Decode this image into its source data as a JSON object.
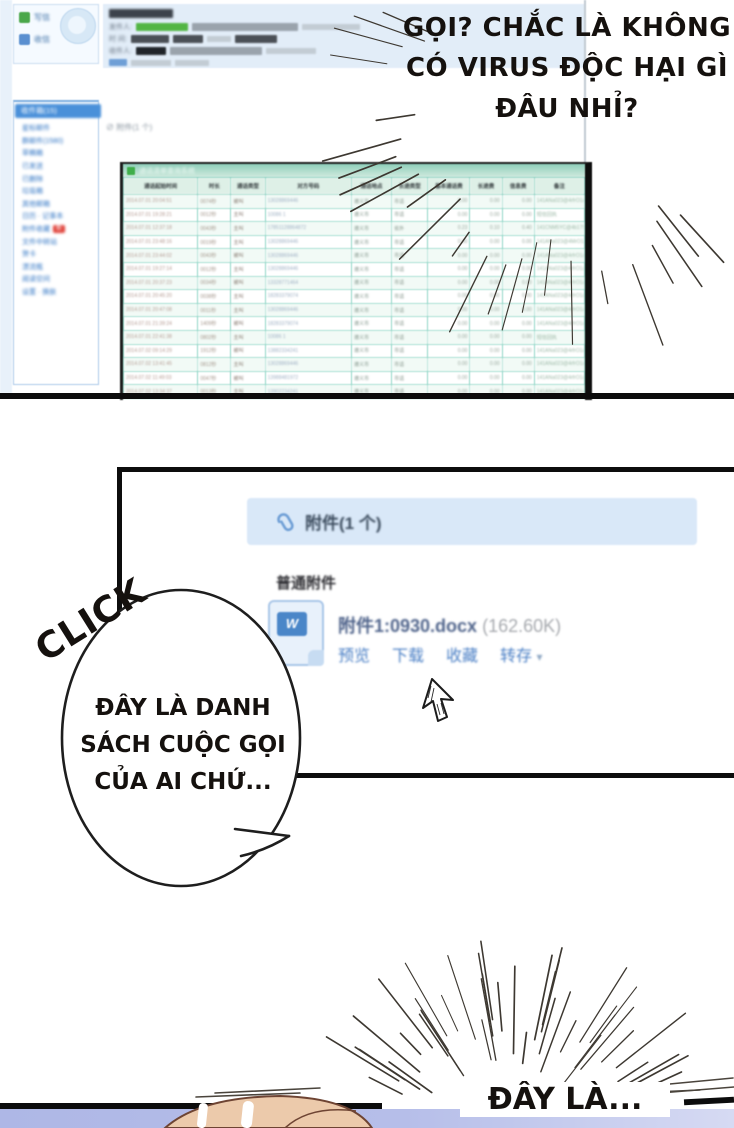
{
  "speech": {
    "bubble_top_lines": [
      "GỌI? CHẮC LÀ KHÔNG",
      "CÓ VIRUS ĐỘC HẠI GÌ",
      "ĐÂU NHỈ?"
    ],
    "click_label": "CLICK",
    "bubble_mid_lines": [
      "ĐÂY LÀ DANH",
      "SÁCH CUỘC GỌI",
      "CỦA AI CHỨ..."
    ],
    "bottom_caption": "ĐÂY LÀ..."
  },
  "mail": {
    "compose_label": "写信",
    "inbox_label": "收信",
    "sidebar": {
      "selected": "收件箱(15)",
      "items": [
        "星标邮件",
        "群邮件(1580)",
        "草稿箱",
        "已发送",
        "已删除",
        "垃圾箱",
        "其他邮箱",
        "日历 · 记事本",
        "附件收藏",
        "文件中转站",
        "贺卡",
        "漂流瓶",
        "阅读空间",
        "设置 · 换肤"
      ],
      "badge_item_index": 8,
      "badge_text": "新"
    },
    "header_fields": {
      "from_label": "发件人:",
      "time_label": "时 间:",
      "to_label": "收件人:"
    },
    "attachment_note": "附件(1 个)"
  },
  "call_table": {
    "window_title": "通话清单查询系统",
    "headers": [
      "通话起始时间",
      "时长",
      "通话类型",
      "对方号码",
      "通话地点",
      "长途类型",
      "基本通话费",
      "长途费",
      "信息费",
      "备注"
    ],
    "rows": [
      [
        "2014.07.01 20:04:51",
        "0074秒",
        "被叫",
        "13028869446",
        "遵义市",
        "市话",
        "0.00",
        "0.00",
        "0.00",
        "141ANa023@4rfrO1a"
      ],
      [
        "2014.07.01 19:28:21",
        "0012秒",
        "主叫",
        "10086 1",
        "遵义市",
        "市话",
        "0.00",
        "0.00",
        "0.00",
        "短信回执"
      ],
      [
        "2014.07.01 12:37:18",
        "0043秒",
        "主叫",
        "17851128864872",
        "遵义市",
        "省外",
        "0.23",
        "0.10",
        "0.40",
        "141CNM5YC@4b17SY"
      ],
      [
        "2014.07.01 23:48:16",
        "0019秒",
        "主叫",
        "13028869446",
        "遵义市",
        "市话",
        "0.00",
        "0.00",
        "0.00",
        "141ANa023@4MrO1a"
      ],
      [
        "2014.07.01 23:44:02",
        "0043秒",
        "被叫",
        "13028869446",
        "遵义市",
        "市话",
        "0.00",
        "0.00",
        "0.00",
        "141ANa023@4rfrO1a"
      ],
      [
        "2014.07.01 19:27:14",
        "0012秒",
        "主叫",
        "13028869446",
        "遵义市",
        "市话",
        "0.00",
        "0.00",
        "0.00",
        "141ANa023@4rfrO1a"
      ],
      [
        "2014.07.01 20:37:23",
        "0034秒",
        "被叫",
        "13328771464",
        "遵义市",
        "市话",
        "0.00",
        "0.00",
        "0.00",
        "141ANa023@4rfrO1a"
      ],
      [
        "2014.07.01 20:45:20",
        "0038秒",
        "主叫",
        "18283379074",
        "遵义市",
        "市话",
        "0.00",
        "0.00",
        "0.00",
        "141ANa023@4rfrO1a"
      ],
      [
        "2014.07.01 20:47:08",
        "0011秒",
        "主叫",
        "13028869446",
        "遵义市",
        "市话",
        "0.00",
        "0.00",
        "0.00",
        "141ANa023@4rfrO1a"
      ],
      [
        "2014.07.01 21:39:24",
        "1409秒",
        "被叫",
        "18283379074",
        "遵义市",
        "市话",
        "0.00",
        "0.00",
        "0.00",
        "141ANa023@4rfrO1a"
      ],
      [
        "2014.07.01 22:41:38",
        "0802秒",
        "主叫",
        "10086 1",
        "遵义市",
        "市话",
        "0.00",
        "0.00",
        "0.00",
        "短信回执"
      ],
      [
        "2014.07.02 09:14:29",
        "1912秒",
        "被叫",
        "13882334241",
        "遵义市",
        "市话",
        "0.00",
        "0.00",
        "0.00",
        "141ANa023@4rfrO1a"
      ],
      [
        "2014.07.02 13:41:45",
        "0812秒",
        "主叫",
        "13028869446",
        "遵义市",
        "市话",
        "0.00",
        "0.00",
        "0.00",
        "141ANa023@4rfrO1a"
      ],
      [
        "2014.07.02 11:49:03",
        "0047秒",
        "被叫",
        "13988481972",
        "遵义市",
        "市话",
        "0.00",
        "0.00",
        "0.00",
        "141ANa023@4rfrO1a"
      ],
      [
        "2014.07.02 13:34:37",
        "0013秒",
        "主叫",
        "13902234241",
        "遵义市",
        "市话",
        "0.00",
        "0.00",
        "0.00",
        "141ANa023@4rfrO1a"
      ]
    ]
  },
  "attachment_panel": {
    "header": "附件(1 个)",
    "section_title": "普通附件",
    "file_name": "附件1:0930.docx",
    "file_size": "(162.60K)",
    "actions": [
      "预览",
      "下载",
      "收藏",
      "转存"
    ],
    "dropdown_caret": "▾",
    "file_icon_letter": "W"
  },
  "colors": {
    "accent_blue": "#4a90d9",
    "link_blue": "#4a7fc5",
    "table_border": "#7fccbc",
    "panel_border": "#111111",
    "lavender": "#b3bce8"
  }
}
